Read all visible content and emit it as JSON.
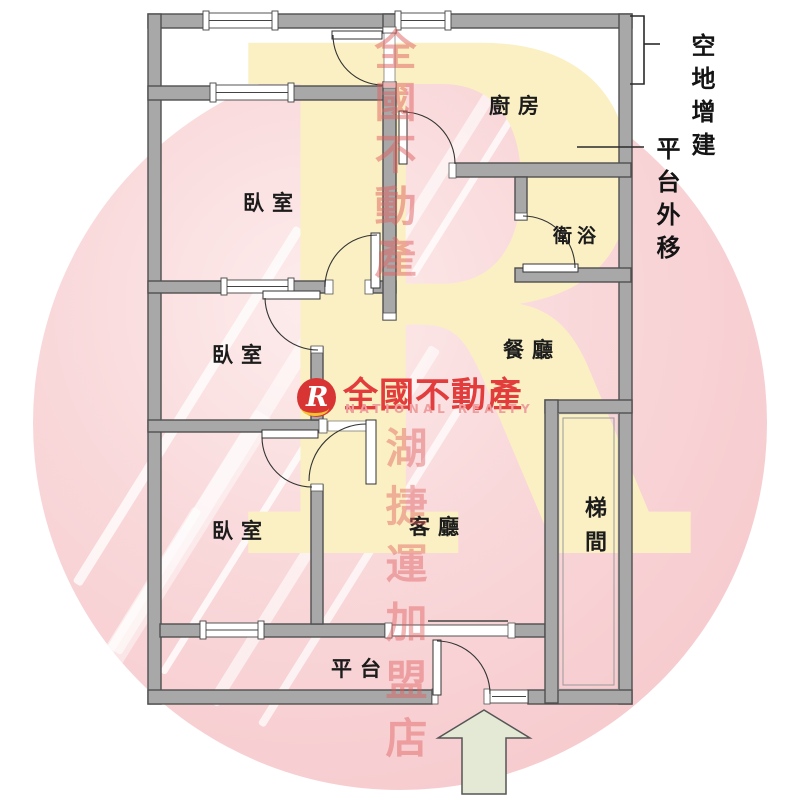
{
  "plan_title": "apartment floor plan",
  "rooms": {
    "kitchen": "廚房",
    "bedroom1": "臥室",
    "bedroom2": "臥室",
    "bedroom3": "臥室",
    "bathroom": "衛浴",
    "dining": "餐廳",
    "living": "客廳",
    "stairwell": "梯間",
    "platform": "平台"
  },
  "annotations": {
    "vacant_land_addition": "空地增建",
    "platform_moved_out": "平台外移"
  },
  "watermark": {
    "brand": "全國不動產",
    "brand_en": "NATIONAL REALTY",
    "column_top": "全國不動產",
    "column_bottom": "湖捷運加盟店",
    "big_letter": "R",
    "logo_letter": "R"
  },
  "icons": {
    "entrance_arrow": "up-arrow entrance marker"
  },
  "colors": {
    "wall_fill": "#a8a8a8",
    "wall_outline": "#4f4f4f",
    "watermark_circle": "#f5c4c8",
    "watermark_letter": "#fbf0c3",
    "watermark_text_red": "#df5f5f",
    "brand_red": "#e23c3c",
    "brand_light_red": "#ee9e9e",
    "logo_circle_red": "#d93434",
    "logo_swoosh_yellow": "#f3c331",
    "arrow_fill": "#e3e9d4",
    "label_black": "#1c1c1c"
  }
}
